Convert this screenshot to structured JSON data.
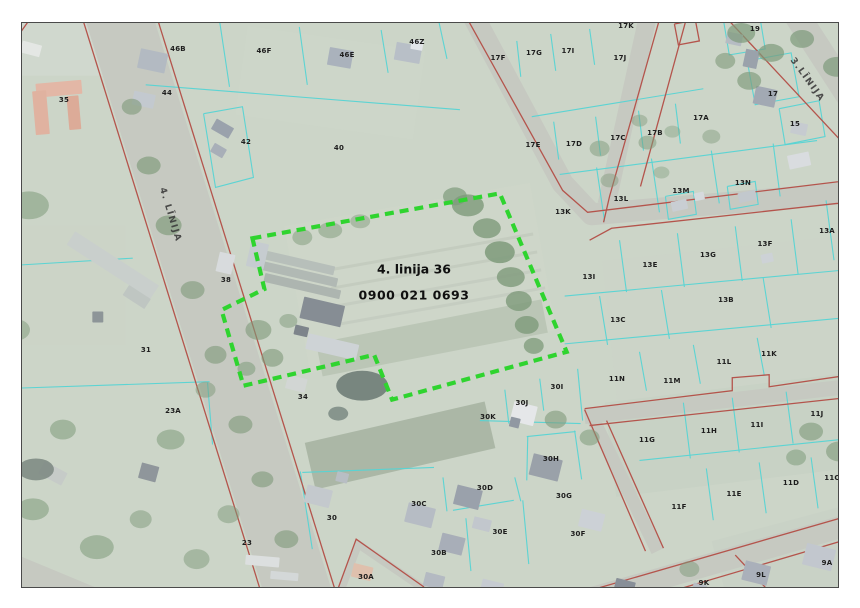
{
  "map": {
    "frame": {
      "x": 21,
      "y": 22,
      "w": 818,
      "h": 566
    },
    "colors": {
      "background": "#ccd5c8",
      "road": "#c6c9c1",
      "red_line": "#b4544c",
      "parcel_line": "#55d4d4",
      "tree": "#7e9a7a",
      "label": "#1d1d1d"
    },
    "highlight": {
      "label_line1": "4. linija 36",
      "label_line2": "0900 021 0693",
      "label_x": 413,
      "label_y": 281,
      "polygon": "252,238 500,193 567,352 392,400 374,355 243,386 221,310 264,289",
      "color": "#2fd42f"
    },
    "road_labels": [
      {
        "text": "4. LĪNIJA",
        "x": 169,
        "y": 214,
        "rot": 73
      },
      {
        "text": "3.LĪNIJA",
        "x": 806,
        "y": 79,
        "rot": 54
      }
    ],
    "parcel_labels": [
      {
        "t": "46B",
        "x": 177,
        "y": 48
      },
      {
        "t": "46F",
        "x": 263,
        "y": 50
      },
      {
        "t": "46E",
        "x": 346,
        "y": 54
      },
      {
        "t": "46Z",
        "x": 416,
        "y": 41
      },
      {
        "t": "44",
        "x": 166,
        "y": 92
      },
      {
        "t": "35",
        "x": 63,
        "y": 99
      },
      {
        "t": "42",
        "x": 245,
        "y": 141
      },
      {
        "t": "40",
        "x": 338,
        "y": 147
      },
      {
        "t": "38",
        "x": 225,
        "y": 279
      },
      {
        "t": "31",
        "x": 145,
        "y": 349
      },
      {
        "t": "23A",
        "x": 172,
        "y": 410
      },
      {
        "t": "34",
        "x": 302,
        "y": 396
      },
      {
        "t": "30",
        "x": 331,
        "y": 517
      },
      {
        "t": "23",
        "x": 246,
        "y": 542
      },
      {
        "t": "30A",
        "x": 365,
        "y": 576
      },
      {
        "t": "17K",
        "x": 625,
        "y": 25
      },
      {
        "t": "17F",
        "x": 497,
        "y": 57
      },
      {
        "t": "17G",
        "x": 533,
        "y": 52
      },
      {
        "t": "17I",
        "x": 567,
        "y": 50
      },
      {
        "t": "17J",
        "x": 619,
        "y": 57
      },
      {
        "t": "19",
        "x": 754,
        "y": 28
      },
      {
        "t": "17",
        "x": 772,
        "y": 93
      },
      {
        "t": "15",
        "x": 794,
        "y": 123
      },
      {
        "t": "17A",
        "x": 700,
        "y": 117
      },
      {
        "t": "17B",
        "x": 654,
        "y": 132
      },
      {
        "t": "17C",
        "x": 617,
        "y": 137
      },
      {
        "t": "17D",
        "x": 573,
        "y": 143
      },
      {
        "t": "17E",
        "x": 532,
        "y": 144
      },
      {
        "t": "13K",
        "x": 562,
        "y": 211
      },
      {
        "t": "13L",
        "x": 620,
        "y": 198
      },
      {
        "t": "13M",
        "x": 680,
        "y": 190
      },
      {
        "t": "13N",
        "x": 742,
        "y": 182
      },
      {
        "t": "13A",
        "x": 826,
        "y": 230
      },
      {
        "t": "13I",
        "x": 588,
        "y": 276
      },
      {
        "t": "13E",
        "x": 649,
        "y": 264
      },
      {
        "t": "13G",
        "x": 707,
        "y": 254
      },
      {
        "t": "13F",
        "x": 764,
        "y": 243
      },
      {
        "t": "13C",
        "x": 617,
        "y": 319
      },
      {
        "t": "13B",
        "x": 725,
        "y": 299
      },
      {
        "t": "11N",
        "x": 616,
        "y": 378
      },
      {
        "t": "11M",
        "x": 671,
        "y": 380
      },
      {
        "t": "11L",
        "x": 723,
        "y": 361
      },
      {
        "t": "11K",
        "x": 768,
        "y": 353
      },
      {
        "t": "11G",
        "x": 646,
        "y": 439
      },
      {
        "t": "11H",
        "x": 708,
        "y": 430
      },
      {
        "t": "11I",
        "x": 756,
        "y": 424
      },
      {
        "t": "11J",
        "x": 816,
        "y": 413
      },
      {
        "t": "11F",
        "x": 678,
        "y": 506
      },
      {
        "t": "11E",
        "x": 733,
        "y": 493
      },
      {
        "t": "11D",
        "x": 790,
        "y": 482
      },
      {
        "t": "11C",
        "x": 831,
        "y": 477
      },
      {
        "t": "30I",
        "x": 556,
        "y": 386
      },
      {
        "t": "30J",
        "x": 521,
        "y": 402
      },
      {
        "t": "30K",
        "x": 487,
        "y": 416
      },
      {
        "t": "30H",
        "x": 550,
        "y": 458
      },
      {
        "t": "30D",
        "x": 484,
        "y": 487
      },
      {
        "t": "30G",
        "x": 563,
        "y": 495
      },
      {
        "t": "30C",
        "x": 418,
        "y": 503
      },
      {
        "t": "30E",
        "x": 499,
        "y": 531
      },
      {
        "t": "30B",
        "x": 438,
        "y": 552
      },
      {
        "t": "30F",
        "x": 577,
        "y": 533
      },
      {
        "t": "9K",
        "x": 703,
        "y": 582
      },
      {
        "t": "9L",
        "x": 760,
        "y": 574
      },
      {
        "t": "9A",
        "x": 826,
        "y": 562
      }
    ],
    "roads": [
      [
        "107,-20 309,630",
        66
      ],
      [
        "460,-10 563,183 592,214 866,191",
        22
      ],
      [
        "654,-10 607,204",
        18
      ],
      [
        "782,-10 866,120",
        26
      ],
      [
        "540,614 876,518",
        22
      ],
      [
        "585,417 866,385",
        15
      ],
      [
        "592,416 658,552",
        13
      ],
      [
        "-10,560 115,612",
        28
      ],
      [
        "338,598 358,545 424,590",
        8
      ]
    ],
    "red_lines": [
      "70,-20 272,630",
      "145,-20 347,630",
      "452,-10 563,190 588,212 866,178",
      "590,240 612,228 866,200",
      "668,-10 610,196 604,222",
      "694,-8 641,186",
      "704,-8 866,166",
      "675,23 696,19 700,40 679,44 675,23",
      "540,606 872,510",
      "558,626 876,532",
      "585,409 733,391 733,378 770,375 770,387 866,373",
      "590,426 866,396",
      "585,410 646,552",
      "607,421 664,549",
      "12,42 46,-6",
      "334,600 356,540 424,588",
      "736,556 790,614"
    ],
    "parcel_lines": [
      "145,84 460,109",
      "218,13 229,86",
      "299,26 307,84",
      "381,29 388,72",
      "437,12 447,58",
      "203,113 242,106 253,177 215,187 203,113",
      "0,266 132,258",
      "0,389 209,382",
      "207,383 212,445",
      "560,174 818,140",
      "597,167 605,221",
      "652,158 660,212",
      "712,150 720,203",
      "774,143 781,196",
      "565,296 866,268",
      "620,240 627,292",
      "678,233 685,287",
      "736,226 743,281",
      "792,219 799,274",
      "565,344 866,316",
      "600,296 608,345",
      "662,290 670,339",
      "764,278 772,328",
      "640,352 647,391",
      "694,345 701,384",
      "758,338 765,375",
      "684,403 691,459",
      "733,398 740,453",
      "787,392 794,444",
      "640,461 842,440",
      "707,469 714,521",
      "760,463 767,514",
      "812,458 819,509",
      "827,200 835,260",
      "505,390 509,424",
      "540,379 544,411",
      "578,369 583,421",
      "480,421 581,424",
      "527,437 576,432",
      "528,437 527,481",
      "575,431 582,480",
      "443,478 447,512",
      "453,511 514,501",
      "515,478 521,502",
      "523,501 529,565",
      "466,519 471,572",
      "302,473 434,468",
      "300,472 312,550",
      "554,121 559,159",
      "596,116 601,155",
      "639,110 644,150",
      "676,103 681,143",
      "532,116 704,88",
      "517,40 521,76",
      "551,33 556,70",
      "590,28 595,64",
      "724,18 760,12 766,48 730,54 724,18",
      "748,60 792,52 800,96 756,104 748,60",
      "780,108 820,100 826,136 786,144 780,108",
      "666,196 694,191 697,214 669,219 666,196",
      "728,186 756,181 759,204 731,209 728,186"
    ],
    "buildings": [
      [
        58,
        88,
        46,
        14,
        -5,
        "#e3b7a6"
      ],
      [
        40,
        112,
        14,
        44,
        -5,
        "#e0b2a0"
      ],
      [
        73,
        112,
        12,
        34,
        -5,
        "#dcab98"
      ],
      [
        30,
        48,
        20,
        12,
        15,
        "#e4e7e4"
      ],
      [
        152,
        60,
        28,
        20,
        12,
        "#b3bac2"
      ],
      [
        143,
        99,
        22,
        14,
        12,
        "#c3c9cf"
      ],
      [
        340,
        57,
        24,
        18,
        10,
        "#aab2bc"
      ],
      [
        408,
        52,
        26,
        18,
        10,
        "#b8bfc7"
      ],
      [
        417,
        44,
        12,
        10,
        10,
        "#e2e5e9"
      ],
      [
        222,
        128,
        20,
        12,
        30,
        "#9aa2ac"
      ],
      [
        218,
        150,
        14,
        10,
        30,
        "#a8afb8"
      ],
      [
        112,
        265,
        100,
        16,
        33,
        "#c9cfcc"
      ],
      [
        136,
        297,
        26,
        12,
        33,
        "#bfc6c2"
      ],
      [
        97,
        317,
        11,
        11,
        0,
        "#8d9598"
      ],
      [
        296,
        262,
        78,
        9,
        13,
        "#b7bfba"
      ],
      [
        299,
        274,
        78,
        9,
        13,
        "#b1b9b4"
      ],
      [
        302,
        286,
        78,
        9,
        13,
        "#adb5b0"
      ],
      [
        257,
        255,
        18,
        26,
        13,
        "#c6ccd0"
      ],
      [
        225,
        263,
        16,
        20,
        13,
        "#d8dbdd"
      ],
      [
        322,
        312,
        42,
        22,
        13,
        "#868d94"
      ],
      [
        332,
        347,
        52,
        16,
        13,
        "#ced3d6"
      ],
      [
        301,
        331,
        14,
        10,
        13,
        "#7d848b"
      ],
      [
        296,
        384,
        20,
        14,
        14,
        "#d2d6d4"
      ],
      [
        318,
        497,
        26,
        18,
        14,
        "#c4c9cd"
      ],
      [
        342,
        478,
        12,
        10,
        14,
        "#b8bec4"
      ],
      [
        420,
        516,
        28,
        20,
        14,
        "#b6bcc4"
      ],
      [
        452,
        545,
        24,
        18,
        14,
        "#a8aeb8"
      ],
      [
        482,
        525,
        18,
        12,
        14,
        "#c2c7cd"
      ],
      [
        468,
        498,
        26,
        20,
        14,
        "#9aa1ab"
      ],
      [
        546,
        468,
        30,
        22,
        14,
        "#9aa1a9"
      ],
      [
        524,
        414,
        24,
        20,
        14,
        "#e5e7e9"
      ],
      [
        515,
        423,
        10,
        10,
        14,
        "#9098a2"
      ],
      [
        592,
        521,
        24,
        18,
        14,
        "#ccd1d6"
      ],
      [
        434,
        582,
        20,
        14,
        14,
        "#b4bac2"
      ],
      [
        492,
        589,
        22,
        14,
        14,
        "#c6cbd1"
      ],
      [
        560,
        599,
        18,
        12,
        14,
        "#9aa2ac"
      ],
      [
        625,
        588,
        20,
        14,
        14,
        "#888f98"
      ],
      [
        362,
        573,
        20,
        14,
        14,
        "#dfc0ad"
      ],
      [
        262,
        562,
        34,
        10,
        5,
        "#dcdfdf"
      ],
      [
        284,
        577,
        28,
        8,
        5,
        "#d4d8d8"
      ],
      [
        52,
        474,
        26,
        14,
        28,
        "#c6cbc8"
      ],
      [
        148,
        473,
        18,
        16,
        15,
        "#8f969b"
      ],
      [
        757,
        574,
        26,
        20,
        14,
        "#aab0ba"
      ],
      [
        820,
        558,
        30,
        22,
        14,
        "#c2c7ce"
      ],
      [
        700,
        590,
        14,
        10,
        14,
        "#b8bec4"
      ],
      [
        766,
        96,
        22,
        18,
        12,
        "#a2a9b3"
      ],
      [
        735,
        38,
        16,
        12,
        12,
        "#b6bcc3"
      ],
      [
        752,
        58,
        14,
        18,
        12,
        "#9aa2ab"
      ],
      [
        800,
        128,
        16,
        12,
        12,
        "#c6cbd0"
      ],
      [
        680,
        205,
        16,
        10,
        -12,
        "#c9ced3"
      ],
      [
        700,
        196,
        10,
        8,
        -12,
        "#d6dadd"
      ],
      [
        748,
        196,
        18,
        10,
        -12,
        "#c2c8cd"
      ],
      [
        800,
        160,
        22,
        14,
        -12,
        "#d9dcdf"
      ],
      [
        768,
        258,
        12,
        9,
        -12,
        "#cdd2d6"
      ]
    ],
    "trees": [
      [
        468,
        205,
        16,
        11,
        0.8
      ],
      [
        487,
        228,
        14,
        10,
        0.8
      ],
      [
        500,
        252,
        15,
        11,
        0.85
      ],
      [
        511,
        277,
        14,
        10,
        0.8
      ],
      [
        519,
        301,
        13,
        10,
        0.8
      ],
      [
        527,
        325,
        12,
        9,
        0.8
      ],
      [
        534,
        346,
        10,
        8,
        0.75
      ],
      [
        455,
        196,
        12,
        9,
        0.7
      ],
      [
        330,
        230,
        12,
        8,
        0.5
      ],
      [
        360,
        221,
        10,
        7,
        0.45
      ],
      [
        302,
        237,
        10,
        8,
        0.5
      ],
      [
        148,
        165,
        12,
        9,
        0.65
      ],
      [
        168,
        225,
        13,
        10,
        0.65
      ],
      [
        192,
        290,
        12,
        9,
        0.6
      ],
      [
        215,
        355,
        11,
        9,
        0.6
      ],
      [
        240,
        425,
        12,
        9,
        0.6
      ],
      [
        262,
        480,
        11,
        8,
        0.6
      ],
      [
        286,
        540,
        12,
        9,
        0.6
      ],
      [
        131,
        106,
        10,
        8,
        0.6
      ],
      [
        28,
        205,
        20,
        14,
        0.55
      ],
      [
        14,
        330,
        15,
        11,
        0.5
      ],
      [
        62,
        430,
        13,
        10,
        0.55
      ],
      [
        170,
        440,
        14,
        10,
        0.55
      ],
      [
        205,
        390,
        10,
        8,
        0.5
      ],
      [
        32,
        510,
        16,
        11,
        0.55
      ],
      [
        96,
        548,
        17,
        12,
        0.55
      ],
      [
        140,
        520,
        11,
        9,
        0.5
      ],
      [
        258,
        330,
        13,
        10,
        0.6
      ],
      [
        272,
        358,
        11,
        9,
        0.6
      ],
      [
        246,
        369,
        9,
        7,
        0.55
      ],
      [
        288,
        321,
        9,
        7,
        0.5
      ],
      [
        742,
        32,
        14,
        10,
        0.7
      ],
      [
        772,
        52,
        13,
        9,
        0.7
      ],
      [
        803,
        38,
        12,
        9,
        0.7
      ],
      [
        838,
        66,
        14,
        10,
        0.7
      ],
      [
        750,
        80,
        12,
        9,
        0.65
      ],
      [
        858,
        42,
        14,
        10,
        0.7
      ],
      [
        726,
        60,
        10,
        8,
        0.6
      ],
      [
        600,
        148,
        10,
        8,
        0.5
      ],
      [
        648,
        142,
        9,
        7,
        0.5
      ],
      [
        712,
        136,
        9,
        7,
        0.45
      ],
      [
        610,
        180,
        9,
        7,
        0.45
      ],
      [
        662,
        172,
        8,
        6,
        0.4
      ],
      [
        812,
        432,
        12,
        9,
        0.6
      ],
      [
        840,
        452,
        13,
        10,
        0.6
      ],
      [
        797,
        458,
        10,
        8,
        0.55
      ],
      [
        852,
        420,
        10,
        7,
        0.5
      ],
      [
        556,
        420,
        11,
        9,
        0.6
      ],
      [
        590,
        438,
        10,
        8,
        0.55
      ],
      [
        228,
        515,
        11,
        9,
        0.5
      ],
      [
        196,
        560,
        13,
        10,
        0.5
      ],
      [
        640,
        120,
        8,
        6,
        0.45
      ],
      [
        673,
        131,
        8,
        6,
        0.4
      ],
      [
        690,
        570,
        10,
        8,
        0.5
      ],
      [
        362,
        386,
        26,
        15,
        0.9,
        "#6f7d77"
      ],
      [
        338,
        414,
        10,
        7,
        0.8,
        "#76847e"
      ],
      [
        35,
        470,
        18,
        11,
        0.8,
        "#75827c"
      ]
    ],
    "fields": [
      [
        420,
        278,
        250,
        150,
        -10,
        "#ced6c9",
        0.9
      ],
      [
        430,
        252,
        210,
        3,
        -10,
        "#c2c9bd",
        0.8
      ],
      [
        434,
        270,
        210,
        3,
        -10,
        "#c2c9bd",
        0.8
      ],
      [
        438,
        288,
        210,
        3,
        -10,
        "#c2c9bd",
        0.7
      ],
      [
        442,
        306,
        210,
        3,
        -10,
        "#c2c9bd",
        0.7
      ],
      [
        432,
        338,
        230,
        34,
        -11,
        "#b6c2b1",
        0.8
      ],
      [
        400,
        446,
        185,
        48,
        -13,
        "#a5b2a0",
        0.85
      ],
      [
        60,
        285,
        130,
        120,
        0,
        "#ccd4c6",
        0.6
      ],
      [
        330,
        82,
        180,
        90,
        8,
        "#cdd6c9",
        0.7
      ],
      [
        740,
        322,
        260,
        150,
        -6,
        "#cbd4c8",
        0.5
      ],
      [
        735,
        435,
        250,
        95,
        -7,
        "#c3cfc1",
        0.5
      ],
      [
        50,
        35,
        120,
        80,
        0,
        "#d2d8d0",
        0.7
      ],
      [
        800,
        560,
        160,
        80,
        -15,
        "#c6d0c4",
        0.6
      ]
    ]
  }
}
